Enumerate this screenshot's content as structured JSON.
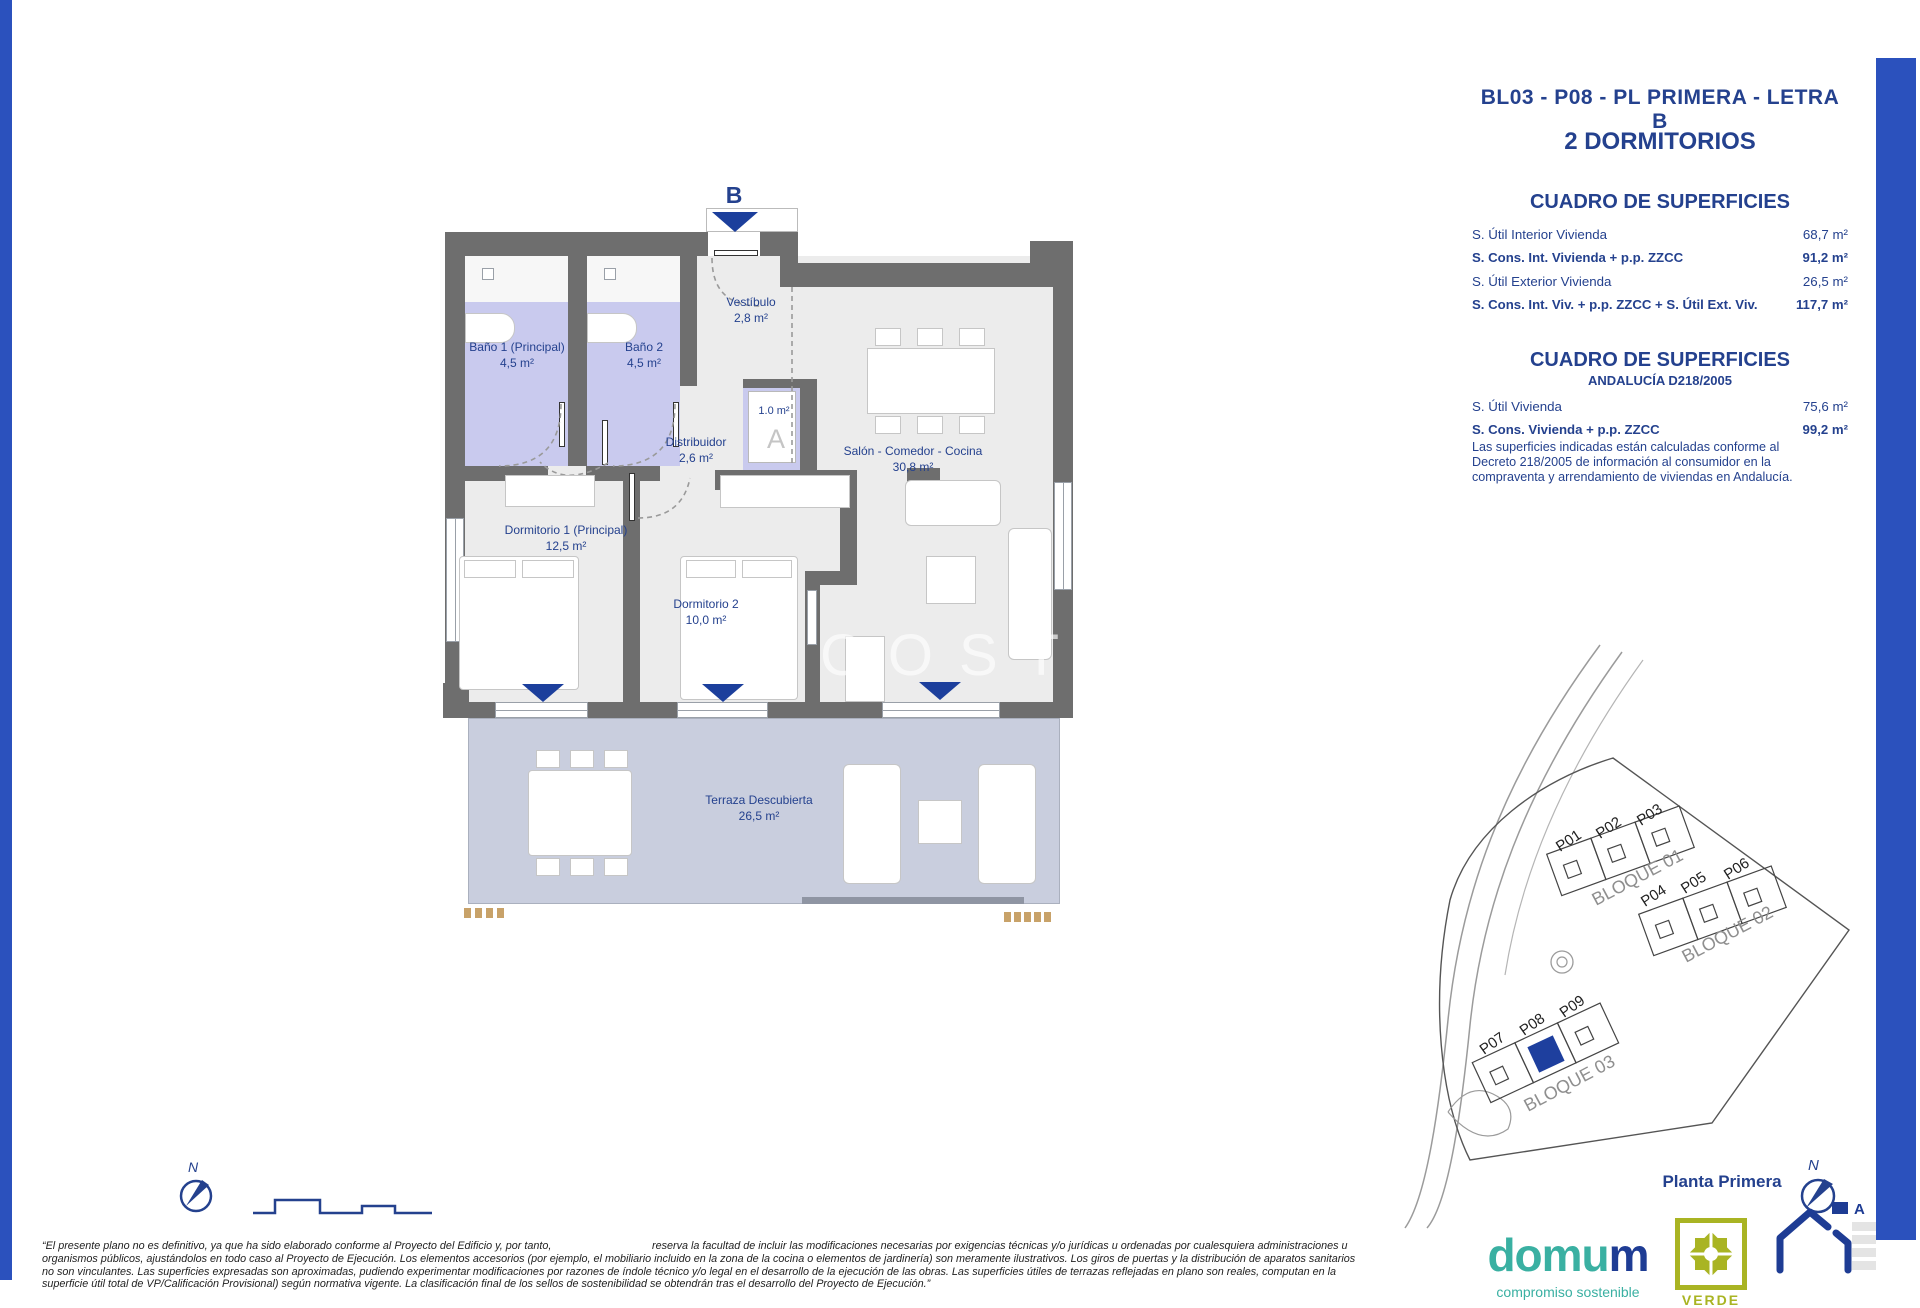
{
  "header": {
    "title": "BL03 - P08 - PL PRIMERA - LETRA B",
    "subtitle": "2 DORMITORIOS"
  },
  "surfaces1": {
    "heading": "CUADRO DE SUPERFICIES",
    "rows": [
      {
        "label": "S. Útil Interior Vivienda",
        "value": "68,7 m²"
      },
      {
        "label": "S. Cons. Int. Vivienda + p.p. ZZCC",
        "value": "91,2 m²"
      },
      {
        "label": "S. Útil Exterior Vivienda",
        "value": "26,5 m²"
      },
      {
        "label": "S. Cons. Int. Viv. + p.p. ZZCC + S. Útil Ext. Viv.",
        "value": "117,7 m²"
      }
    ]
  },
  "surfaces2": {
    "heading": "CUADRO DE SUPERFICIES",
    "subheading": "ANDALUCÍA D218/2005",
    "rows": [
      {
        "label": "S. Útil Vivienda",
        "value": "75,6 m²"
      },
      {
        "label": "S. Cons. Vivienda + p.p. ZZCC",
        "value": "99,2 m²"
      }
    ],
    "note": "Las superficies indicadas están calculadas conforme al Decreto 218/2005 de información al consumidor en la compraventa y arrendamiento de viviendas en Andalucía."
  },
  "plan": {
    "entrance_label": "B",
    "watermark": "COSTA",
    "closet_area": "1.0 m²",
    "closet_letter": "A",
    "rooms": [
      {
        "name": "Vestíbulo",
        "area": "2,8 m²"
      },
      {
        "name": "Baño 1 (Principal)",
        "area": "4,5 m²"
      },
      {
        "name": "Baño 2",
        "area": "4,5 m²"
      },
      {
        "name": "Distribuidor",
        "area": "2,6 m²"
      },
      {
        "name": "Salón - Comedor - Cocina",
        "area": "30,8 m²"
      },
      {
        "name": "Dormitorio 1 (Principal)",
        "area": "12,5 m²"
      },
      {
        "name": "Dormitorio 2",
        "area": "10,0 m²"
      },
      {
        "name": "Terraza Descubierta",
        "area": "26,5 m²"
      }
    ]
  },
  "siteplan": {
    "units": [
      "P01",
      "P02",
      "P03",
      "P04",
      "P05",
      "P06",
      "P07",
      "P08",
      "P09"
    ],
    "blocks": [
      "BLOQUE 01",
      "BLOQUE 02",
      "BLOQUE 03"
    ],
    "caption": "Planta Primera",
    "north": "N"
  },
  "scalebar": {
    "north": "N"
  },
  "footer": {
    "line1a": "“El presente plano no es definitivo, ya que ha sido elaborado conforme al Proyecto del Edificio y, por tanto,",
    "line1b": "reserva la facultad de incluir las modificaciones necesarias por exigencias técnicas y/o jurídicas u ordenadas por cualesquiera administraciones u",
    "line2": "organismos públicos, ajustándolos en todo caso al Proyecto de Ejecución. Los elementos accesorios (por ejemplo, el mobiliario incluido en la zona de la cocina o elementos de jardinería) son meramente ilustrativos. Los giros de puertas y la distribución de aparatos sanitarios",
    "line3": "no son vinculantes. Las superficies expresadas son aproximadas, pudiendo experimentar modificaciones por razones de índole técnico y/o legal en el desarrollo de la ejecución de las obras. Las superficies útiles de terrazas reflejadas en plano son reales, computan en la",
    "line4": "superficie útil total de VP/Calificación Provisional) según normativa vigente. La clasificación final de los sellos de sostenibilidad se obtendrán tras el desarrollo del Proyecto de Ejecución.”"
  },
  "branding": {
    "domum_a": "domu",
    "domum_b": "m",
    "tagline": "compromiso sostenible",
    "verde": "VERDE",
    "energy_letter": "A"
  }
}
